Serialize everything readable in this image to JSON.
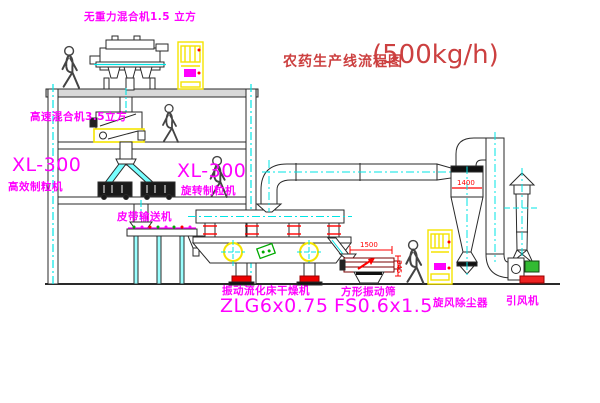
{
  "title": {
    "line_cn": "农药生产线流程图",
    "capacity": "(500kg/h)"
  },
  "labels": {
    "mixer_top": "无重力混合机1.5 立方",
    "mixer_second": "高速混合机3.5立方",
    "granulator_left_model": "XL-300",
    "granulator_left_name": "高效制粒机",
    "granulator_right_model": "XL-300",
    "granulator_right_name": "旋转制粒机",
    "belt_conveyor": "皮带输送机",
    "dryer_name": "振动流化床干燥机",
    "dryer_model": "ZLG6x0.75",
    "sieve_name": "方形振动筛",
    "sieve_model": "FS0.6x1.5",
    "cyclone": "旋风除尘器",
    "fan": "引风机"
  },
  "dimensions": {
    "cyclone_width": "1400",
    "sieve_length": "1500",
    "sieve_height": "345"
  },
  "colors": {
    "label_magenta": "#ff00ff",
    "centerline_cyan": "#00e5e5",
    "highlight_yellow": "#f5e400",
    "dimension_red": "#ff0000",
    "title_red": "#cc4040",
    "line_dark": "#2a2a2a",
    "material_green": "#00aa00"
  }
}
